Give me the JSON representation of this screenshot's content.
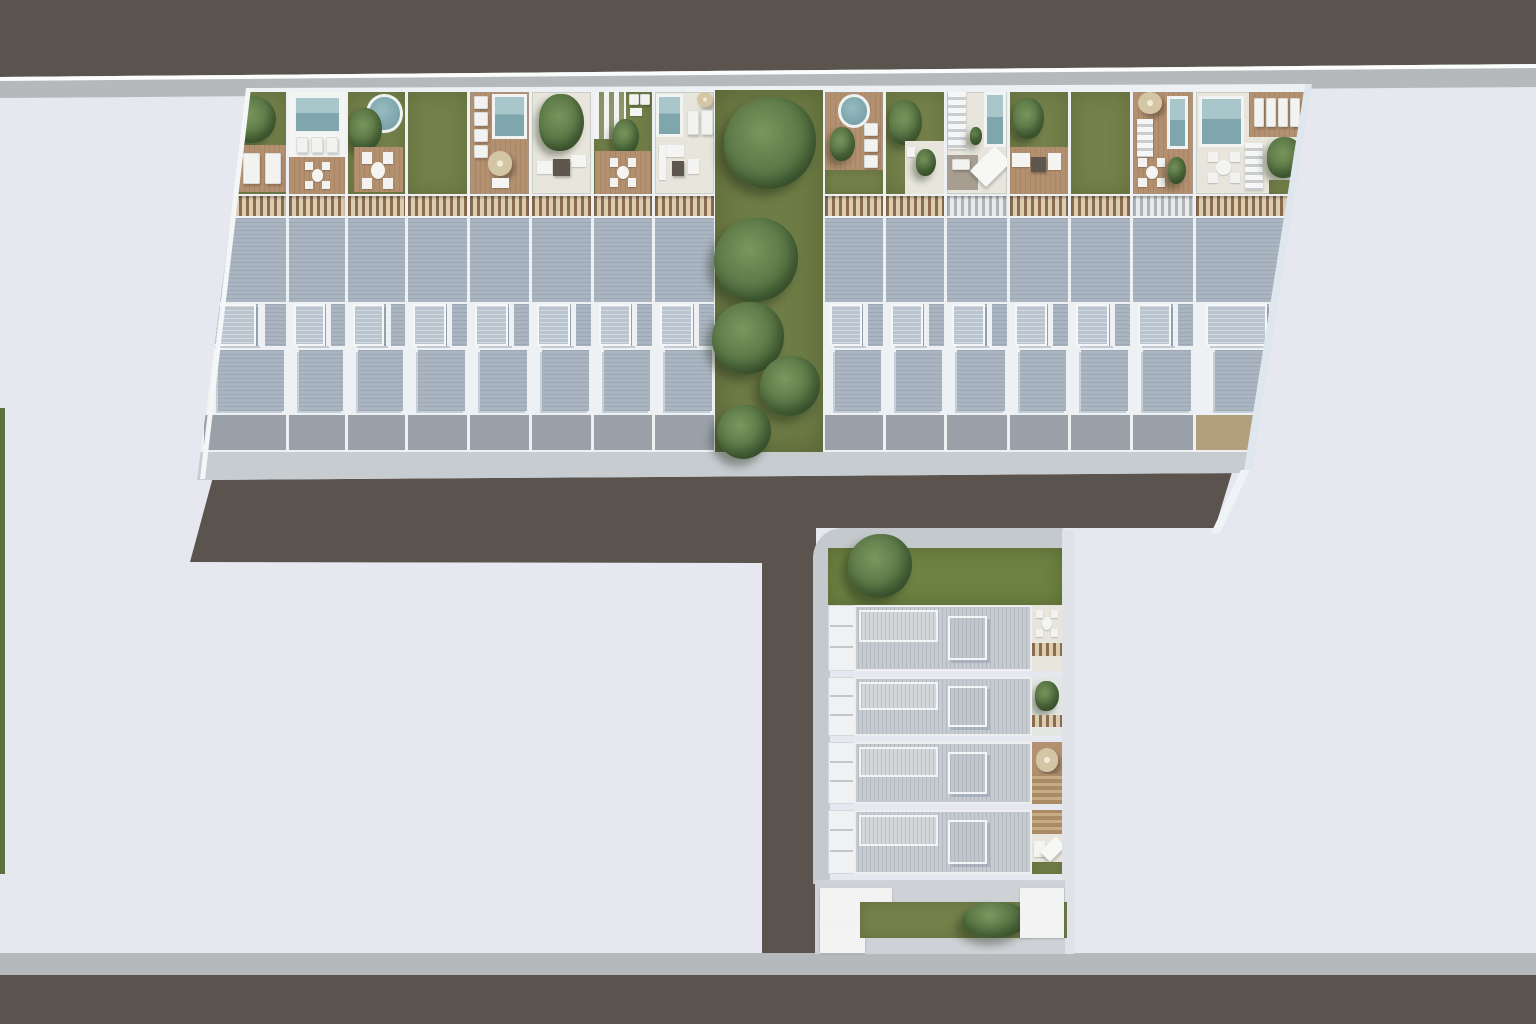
{
  "scene": {
    "width": 1536,
    "height": 1024,
    "description": "Aerial top-down 3D render of a residential townhouse development site plan with roof terraces, pools, gardens, tree strip and surrounding roads"
  },
  "colors": {
    "bg": "#e6e7ef",
    "road": "#5b544e",
    "sidewalk": "#b6b9bc",
    "walk": "#c7ccd1",
    "curb": "#dfe3e8",
    "frame": "#eef1f3",
    "roof": "#abb5c1",
    "rib": "#9da8b5",
    "skylight": "#bac4ce",
    "pline": "#99a0a8",
    "pcell": "#eff1f3",
    "grass": "#75814b",
    "lawn": "#6e7c46",
    "deck": "#b39070",
    "patio": "#e7e5dc",
    "fence": "#8a6d4f",
    "fencegap": "#dcccb0",
    "lroof": "#c6cbd0",
    "lrib": "#b4bac1"
  },
  "upper_building": {
    "rows": {
      "terr_top": 10,
      "terr_h": 102,
      "fence_top": 114,
      "fence_h": 20,
      "roof1_top": 134,
      "roof1_h": 86,
      "sky_top": 222,
      "sky_h": 42,
      "roof2_top": 266,
      "roof2_h": 64,
      "pav_top": 333,
      "pav_h": 35
    },
    "left_edges": [
      12,
      97,
      156,
      216,
      278,
      340,
      402,
      463,
      525
    ],
    "right_edges": [
      633,
      694,
      755,
      818,
      879,
      941,
      1004,
      1118
    ],
    "terraces_left": [
      {
        "base": "grass",
        "fence": "wood",
        "items": [
          [
            "bush",
            30,
            4,
            58,
            46
          ],
          [
            "deck",
            18,
            52,
            82,
            46
          ],
          [
            "lounger",
            48,
            60,
            20,
            30
          ],
          [
            "lounger",
            74,
            60,
            20,
            30
          ],
          [
            "white",
            30,
            64,
            12,
            22
          ]
        ]
      },
      {
        "base": "patio",
        "fence": "wood",
        "items": [
          [
            "white",
            0,
            0,
            100,
            64
          ],
          [
            "pool",
            8,
            3,
            86,
            38
          ],
          [
            "lounger",
            12,
            44,
            22,
            16
          ],
          [
            "lounger",
            39,
            44,
            22,
            16
          ],
          [
            "lounger",
            66,
            44,
            22,
            16
          ],
          [
            "deck",
            0,
            64,
            100,
            36
          ],
          [
            "tableset",
            28,
            68,
            46,
            28
          ]
        ]
      },
      {
        "base": "grass",
        "fence": "wood",
        "items": [
          [
            "rpool",
            32,
            2,
            64,
            38
          ],
          [
            "bush",
            2,
            16,
            58,
            42
          ],
          [
            "deck",
            10,
            54,
            86,
            44
          ],
          [
            "tableset",
            24,
            58,
            56,
            38
          ]
        ]
      },
      {
        "base": "grass",
        "fence": "wood",
        "items": []
      },
      {
        "base": "deck",
        "fence": "wood",
        "items": [
          [
            "lounger",
            6,
            4,
            24,
            13
          ],
          [
            "lounger",
            6,
            20,
            24,
            13
          ],
          [
            "lounger",
            6,
            36,
            24,
            13
          ],
          [
            "lounger",
            6,
            52,
            24,
            13
          ],
          [
            "pool",
            38,
            2,
            58,
            44
          ],
          [
            "umbrella",
            30,
            58,
            42,
            24
          ],
          [
            "white",
            38,
            84,
            28,
            10
          ]
        ]
      },
      {
        "base": "patio",
        "fence": "wood",
        "items": [
          [
            "bush",
            12,
            2,
            76,
            56
          ],
          [
            "white",
            8,
            68,
            26,
            12
          ],
          [
            "white",
            66,
            62,
            26,
            12
          ],
          [
            "dark",
            36,
            66,
            28,
            16
          ]
        ]
      },
      {
        "base": "grass",
        "fence": "wood",
        "items": [
          [
            "pergola",
            0,
            0,
            56,
            46
          ],
          [
            "lounger",
            60,
            2,
            17,
            11
          ],
          [
            "lounger",
            80,
            2,
            17,
            11
          ],
          [
            "white",
            62,
            16,
            20,
            8
          ],
          [
            "bush",
            32,
            26,
            46,
            36
          ],
          [
            "deck",
            2,
            58,
            96,
            42
          ],
          [
            "tableset",
            26,
            64,
            48,
            30
          ]
        ]
      },
      {
        "base": "patio",
        "fence": "wood",
        "items": [
          [
            "pool",
            2,
            2,
            46,
            42
          ],
          [
            "umbrella",
            72,
            0,
            26,
            15
          ],
          [
            "lounger",
            54,
            18,
            20,
            24
          ],
          [
            "lounger",
            78,
            18,
            20,
            24
          ],
          [
            "white",
            6,
            52,
            44,
            12
          ],
          [
            "white",
            6,
            52,
            12,
            34
          ],
          [
            "dark",
            28,
            68,
            22,
            14
          ],
          [
            "white",
            56,
            66,
            18,
            14
          ]
        ]
      }
    ],
    "terraces_right": [
      {
        "base": "deck",
        "fence": "wood",
        "items": [
          [
            "rpool",
            22,
            2,
            56,
            33
          ],
          [
            "bush",
            8,
            34,
            44,
            34
          ],
          [
            "lounger",
            68,
            30,
            24,
            13
          ],
          [
            "lounger",
            68,
            46,
            24,
            13
          ],
          [
            "lounger",
            68,
            62,
            24,
            13
          ],
          [
            "grass",
            0,
            76,
            100,
            24
          ]
        ]
      },
      {
        "base": "grass",
        "fence": "wood",
        "items": [
          [
            "bush",
            6,
            8,
            56,
            44
          ],
          [
            "patio",
            32,
            48,
            68,
            52
          ],
          [
            "bush",
            52,
            56,
            34,
            26
          ],
          [
            "white",
            36,
            54,
            14,
            10
          ]
        ]
      },
      {
        "base": "patio",
        "fence": "light",
        "items": [
          [
            "steps",
            2,
            0,
            30,
            56
          ],
          [
            "pool",
            62,
            0,
            36,
            54
          ],
          [
            "bush",
            38,
            34,
            20,
            18
          ],
          [
            "gdeck",
            0,
            62,
            52,
            34
          ],
          [
            "canopy",
            54,
            56,
            38,
            34
          ],
          [
            "lounger",
            8,
            66,
            30,
            10
          ]
        ]
      },
      {
        "base": "grass",
        "fence": "wood",
        "items": [
          [
            "bush",
            6,
            6,
            52,
            40
          ],
          [
            "deck",
            0,
            54,
            100,
            46
          ],
          [
            "white",
            4,
            60,
            30,
            14
          ],
          [
            "dark",
            36,
            64,
            26,
            14
          ],
          [
            "white",
            66,
            60,
            22,
            16
          ]
        ]
      },
      {
        "base": "grass",
        "fence": "wood",
        "items": []
      },
      {
        "base": "deck",
        "fence": "light",
        "items": [
          [
            "umbrella",
            8,
            0,
            40,
            22
          ],
          [
            "steps",
            6,
            26,
            28,
            38
          ],
          [
            "pool",
            56,
            4,
            36,
            52
          ],
          [
            "tableset",
            8,
            64,
            46,
            30
          ],
          [
            "bush",
            58,
            64,
            30,
            26
          ]
        ]
      },
      {
        "base": "patio",
        "fence": "wood",
        "items": [
          [
            "pool",
            3,
            4,
            40,
            50
          ],
          [
            "deck",
            48,
            0,
            52,
            44
          ],
          [
            "lounger",
            52,
            6,
            9,
            28
          ],
          [
            "lounger",
            63,
            6,
            9,
            28
          ],
          [
            "lounger",
            74,
            6,
            9,
            28
          ],
          [
            "lounger",
            85,
            6,
            9,
            28
          ],
          [
            "tableset",
            10,
            58,
            30,
            32
          ],
          [
            "steps",
            44,
            50,
            16,
            46
          ],
          [
            "bush",
            64,
            44,
            32,
            40
          ],
          [
            "grass",
            66,
            86,
            34,
            14
          ]
        ]
      }
    ]
  },
  "green_strip": {
    "x": 525,
    "y": 8,
    "w": 108,
    "h": 362,
    "trees": [
      [
        580,
        53,
        92
      ],
      [
        566,
        170,
        84
      ],
      [
        558,
        248,
        72
      ],
      [
        600,
        296,
        60
      ],
      [
        554,
        342,
        54
      ]
    ]
  },
  "lower_block": {
    "tree": [
      20,
      -14,
      64
    ],
    "rows": [
      {
        "top": 77,
        "h": 70,
        "garden": {
          "base": "patio",
          "items": [
            [
              "tableset",
              12,
              6,
              76,
              44
            ],
            [
              "fence",
              0,
              58,
              100,
              20
            ]
          ]
        }
      },
      {
        "top": 149,
        "h": 63,
        "garden": {
          "base": "lightpatio",
          "items": [
            [
              "bush",
              10,
              6,
              80,
              52
            ],
            [
              "fence",
              0,
              64,
              100,
              20
            ]
          ]
        }
      },
      {
        "top": 214,
        "h": 66,
        "garden": {
          "base": "deck",
          "items": [
            [
              "umbrella",
              12,
              10,
              76,
              38
            ],
            [
              "woodslats",
              0,
              52,
              100,
              48
            ]
          ]
        }
      },
      {
        "top": 282,
        "h": 68,
        "garden": {
          "base": "patio",
          "items": [
            [
              "woodslats",
              0,
              0,
              100,
              38
            ],
            [
              "white",
              6,
              48,
              38,
              26
            ],
            [
              "canopy",
              48,
              44,
              46,
              34
            ],
            [
              "grass",
              0,
              82,
              100,
              18
            ]
          ]
        }
      }
    ],
    "terr_x": 15,
    "terr_w": 27,
    "roof_x": 41,
    "roof_w": 178,
    "garden_x": 219,
    "garden_w": 30,
    "bottom": {
      "bush": [
        147,
        22,
        66
      ]
    }
  }
}
